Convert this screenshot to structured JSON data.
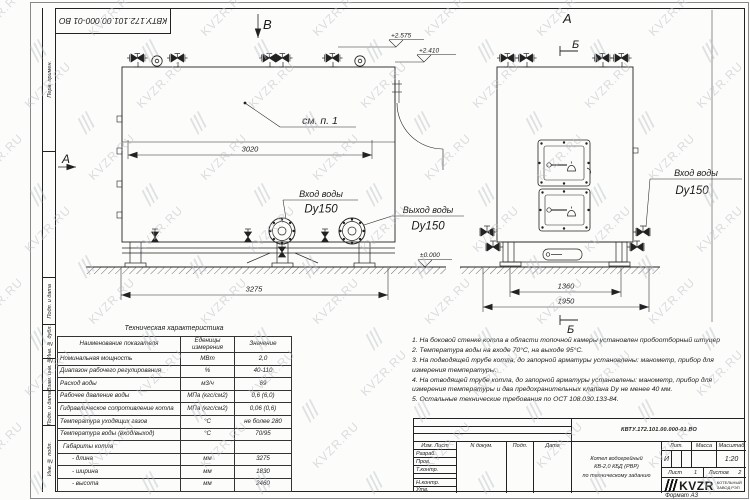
{
  "watermark": {
    "text": "KVZR.RU"
  },
  "stamp_top": {
    "designation_rotated": "КВТУ.172.101.00.000-01  ВО"
  },
  "frame_labels": [
    "Перв. примен.",
    "",
    "Подп. и дата",
    "Инв. № дубл.",
    "Взам. инв. №",
    "Подп. и дата",
    "Инв. № подл."
  ],
  "views": {
    "front": {
      "view_arrow_top": "В",
      "view_arrow_left": "А",
      "callout": "см. п. 1",
      "elevations": {
        "top1": "+2.575",
        "top2": "+2.410",
        "ground": "±0.000"
      },
      "dims": {
        "body_width": "3020",
        "overall_length": "3275"
      },
      "inlet": {
        "line1": "Вход воды",
        "line2": "Dy150"
      },
      "outlet": {
        "line1": "Выход воды",
        "line2": "Dy150"
      }
    },
    "side": {
      "title": "А",
      "section_top": "Б",
      "section_bottom": "Б",
      "dims": {
        "base_width": "1360",
        "overall_width": "1950"
      },
      "inlet": {
        "line1": "Вход воды",
        "line2": "Dy150"
      }
    }
  },
  "tech_table": {
    "title": "Техническая характеристика",
    "headers": [
      "Наименование показателя",
      "Еденицы измерения",
      "Значение"
    ],
    "rows": [
      {
        "name": "Номинальная мощность",
        "unit": "МВт",
        "value": "2,0"
      },
      {
        "name": "Диапазон рабочего регулирования",
        "unit": "%",
        "value": "40-110"
      },
      {
        "name": "Расход воды",
        "unit": "м3/ч",
        "value": "69"
      },
      {
        "name": "Рабочее давление воды",
        "unit": "МПа (кгс/см2)",
        "value": "0,6 (6,0)"
      },
      {
        "name": "Гидравлическое сопротивление котла",
        "unit": "МПа (кгс/см2)",
        "value": "0,06 (0,6)"
      },
      {
        "name": "Температура уходящих газов",
        "unit": "°С",
        "value": "не более 280"
      },
      {
        "name": "Температура воды (вход/выход)",
        "unit": "°С",
        "value": "70/95"
      },
      {
        "name": "Габариты котла",
        "unit": "",
        "value": ""
      },
      {
        "name": "- длина",
        "unit": "мм",
        "value": "3275"
      },
      {
        "name": "- ширина",
        "unit": "мм",
        "value": "1830"
      },
      {
        "name": "- высота",
        "unit": "мм",
        "value": "2460"
      }
    ]
  },
  "notes": {
    "items": [
      "1.  На боковой стенке котла в области топочной камеры установлен пробоотборный штуцер",
      "2.  Температура воды на входе 70°С, на выходе 95°С.",
      "3.  На подводящей трубе котла, до запорной арматуры установлены: манометр, прибор для измерения температуры.",
      "4.  На отводящей трубе котла, до запорной арматуры установлены: манометр, прибор для измерения температуры и два предохранительных клапана Dу не менее 40 мм.",
      "5.  Остальные технические требования по ОСТ 108.030.133-84."
    ]
  },
  "title_block": {
    "designation": "КВТУ.172.101.00.000-01  ВО",
    "doc_name_lines": [
      "Котел водогрейный",
      "КВ-2,0 КБД (РВР)",
      "по техническому заданию"
    ],
    "header_cols": [
      "Изм. Лист",
      "N докум.",
      "Подп.",
      "Дата"
    ],
    "row_labels": [
      "Разраб.",
      "Пров.",
      "Т.контр.",
      "",
      "Н.контр.",
      "Утв."
    ],
    "lit_label": "Лит.",
    "mass_label": "Масса",
    "scale_label": "Масштаб",
    "lit_value": "И",
    "scale_value": "1:20",
    "sheet_label": "Лист",
    "sheet_value": "1",
    "sheets_label": "Листов",
    "sheets_value": "2",
    "company": "KVZR",
    "company_sub1": "КОТЕЛЬНЫЙ",
    "company_sub2": "ЗАВОД РЭП",
    "format_text": "Формат   А3"
  }
}
